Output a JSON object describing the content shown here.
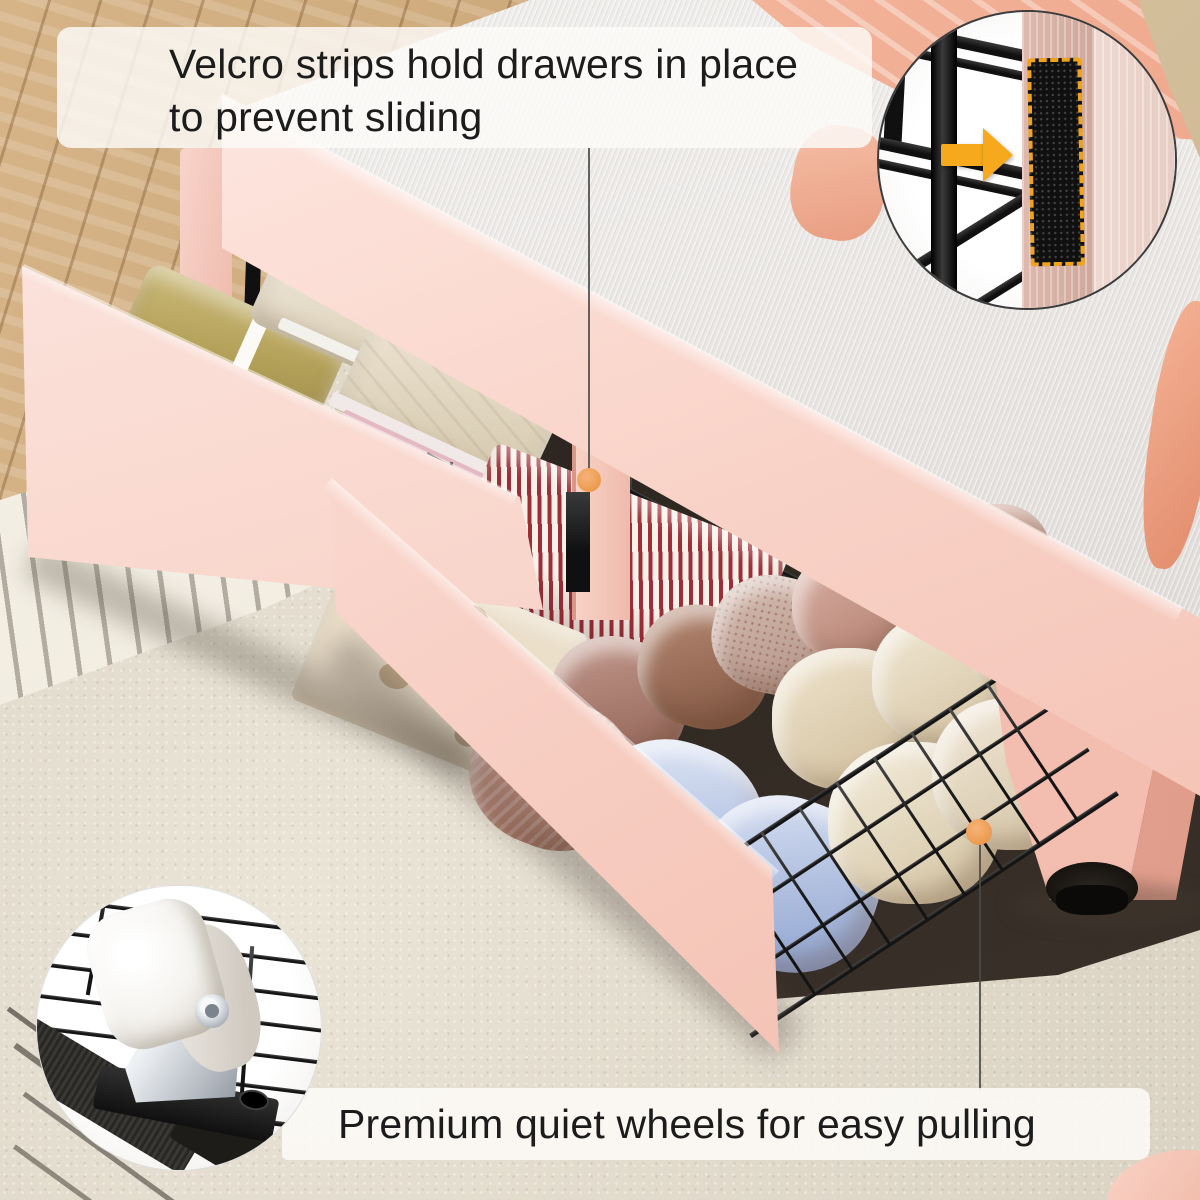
{
  "page": {
    "description": "Product feature photo of a pink upholstered bed with two pull-out under-bed storage drawers full of folded and rolled clothes, with two circular close-up insets and caption callouts"
  },
  "annotations": {
    "top_caption": {
      "line1": "Velcro strips hold drawers in place",
      "line2": "to prevent sliding"
    },
    "bottom_caption": {
      "text": "Premium quiet wheels for easy pulling"
    }
  },
  "insets": [
    {
      "name": "velcro-strip-inset",
      "icon": "orange-arrow-icon",
      "subject": "black velcro strip outlined with orange dashes on drawer post"
    },
    {
      "name": "wheel-inset",
      "icon": "caster-wheel-icon",
      "subject": "white caster wheel with silver bracket on wire drawer base"
    }
  ],
  "callouts": [
    {
      "name": "velcro-callout",
      "marker": "orange-dot",
      "line": "vertical"
    },
    {
      "name": "wheel-callout",
      "marker": "orange-dot",
      "line": "vertical"
    }
  ],
  "colors": {
    "accent_orange_dot": "#F0A052",
    "arrow_yellow": "#F6A91C",
    "velcro_dash_orange": "#F1A31B",
    "bed_pink": "#F8D2C7",
    "mattress_gray": "#E8E5E2",
    "peach_blanket": "#F2B097",
    "carpet_beige": "#E0D9CA",
    "wood_tan": "#C9A774",
    "wire_black": "#141414",
    "caption_text": "#1C1C1C",
    "caption_band": "#FDFBF9"
  }
}
